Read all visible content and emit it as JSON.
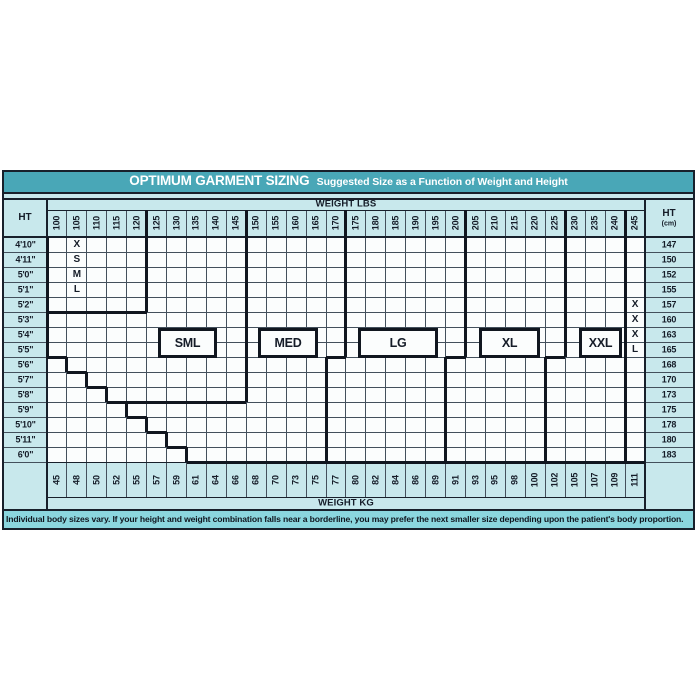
{
  "title": {
    "main": "OPTIMUM GARMENT SIZING",
    "subtitle": "Suggested Size as a Function of Weight and Height"
  },
  "headers": {
    "weight_top": "WEIGHT LBS",
    "weight_bottom": "WEIGHT KG",
    "height_left": "HT",
    "height_right": "HT",
    "height_right_unit": "(cm)"
  },
  "weights_lbs": [
    "100",
    "105",
    "110",
    "115",
    "120",
    "125",
    "130",
    "135",
    "140",
    "145",
    "150",
    "155",
    "160",
    "165",
    "170",
    "175",
    "180",
    "185",
    "190",
    "195",
    "200",
    "205",
    "210",
    "215",
    "220",
    "225",
    "230",
    "235",
    "240",
    "245"
  ],
  "weights_kg": [
    "45",
    "48",
    "50",
    "52",
    "55",
    "57",
    "59",
    "61",
    "64",
    "66",
    "68",
    "70",
    "73",
    "75",
    "77",
    "80",
    "82",
    "84",
    "86",
    "89",
    "91",
    "93",
    "95",
    "98",
    "100",
    "102",
    "105",
    "107",
    "109",
    "111"
  ],
  "heights_ft": [
    "4'10\"",
    "4'11\"",
    "5'0\"",
    "5'1\"",
    "5'2\"",
    "5'3\"",
    "5'4\"",
    "5'5\"",
    "5'6\"",
    "5'7\"",
    "5'8\"",
    "5'9\"",
    "5'10\"",
    "5'11\"",
    "6'0\""
  ],
  "heights_cm": [
    "147",
    "150",
    "152",
    "155",
    "157",
    "160",
    "163",
    "165",
    "168",
    "170",
    "173",
    "175",
    "178",
    "180",
    "183"
  ],
  "region_letters": {
    "left_vertical": [
      "X",
      "S",
      "M",
      "L"
    ],
    "right_vertical": [
      "X",
      "X",
      "X",
      "L"
    ]
  },
  "size_boxes": [
    "SML",
    "MED",
    "LG",
    "XL",
    "XXL"
  ],
  "footer": "Individual body sizes vary. If your height and weight combination falls near a borderline, you may prefer the next smaller size depending upon the patient's body proportion.",
  "colors": {
    "teal": "#49a7b7",
    "panel_bg": "#c8e8ec",
    "footer_bg": "#8bd6de",
    "cell_bg": "#fbfdfd",
    "line_dark": "#18202b",
    "line_thick": "#10161f",
    "line_thin": "#43505c",
    "text_dark": "#151c28"
  },
  "chart_data": {
    "type": "table",
    "title": "OPTIMUM GARMENT SIZING",
    "subtitle": "Suggested Size as a Function of Weight and Height",
    "x_axis": {
      "label": "WEIGHT LBS",
      "ticks": [
        100,
        105,
        110,
        115,
        120,
        125,
        130,
        135,
        140,
        145,
        150,
        155,
        160,
        165,
        170,
        175,
        180,
        185,
        190,
        195,
        200,
        205,
        210,
        215,
        220,
        225,
        230,
        235,
        240,
        245
      ]
    },
    "x_axis_secondary": {
      "label": "WEIGHT KG",
      "ticks": [
        45,
        48,
        50,
        52,
        55,
        57,
        59,
        61,
        64,
        66,
        68,
        70,
        73,
        75,
        77,
        80,
        82,
        84,
        86,
        89,
        91,
        93,
        95,
        98,
        100,
        102,
        105,
        107,
        109,
        111
      ]
    },
    "y_axis": {
      "label": "HT",
      "ticks": [
        "4'10\"",
        "4'11\"",
        "5'0\"",
        "5'1\"",
        "5'2\"",
        "5'3\"",
        "5'4\"",
        "5'5\"",
        "5'6\"",
        "5'7\"",
        "5'8\"",
        "5'9\"",
        "5'10\"",
        "5'11\"",
        "6'0\""
      ]
    },
    "y_axis_secondary": {
      "label": "HT (cm)",
      "ticks": [
        147,
        150,
        152,
        155,
        157,
        160,
        163,
        165,
        168,
        170,
        173,
        175,
        178,
        180,
        183
      ]
    },
    "grid": "on",
    "sizes": [
      "XSML",
      "SML",
      "MED",
      "LG",
      "XL",
      "XXL",
      "XXXL"
    ],
    "regions": [
      {
        "size": "XSML",
        "weight_lbs": [
          100,
          120
        ],
        "heights": [
          "4'10\"",
          "5'2\""
        ]
      },
      {
        "size": "SML",
        "weight_lbs": [
          100,
          145
        ],
        "heights": [
          "4'10\"",
          "5'8\""
        ]
      },
      {
        "size": "MED",
        "weight_lbs": [
          150,
          170
        ],
        "weight_lbs_above_5ft6": [
          150,
          165
        ]
      },
      {
        "size": "LG",
        "weight_lbs": [
          175,
          200
        ],
        "weight_lbs_above_5ft6": [
          170,
          195
        ]
      },
      {
        "size": "XL",
        "weight_lbs": [
          205,
          225
        ],
        "weight_lbs_above_5ft6": [
          200,
          220
        ]
      },
      {
        "size": "XXL",
        "weight_lbs": [
          230,
          240
        ],
        "weight_lbs_above_5ft6": [
          225,
          240
        ]
      },
      {
        "size": "XXXL",
        "weight_lbs": [
          245,
          245
        ],
        "heights": [
          "5'2\"",
          "5'5\""
        ]
      }
    ],
    "note": "Stair-step lower-left boundary: minimum charted weight rises one 5-lb column per inch of height from 5'6\" to 6'0\"."
  }
}
